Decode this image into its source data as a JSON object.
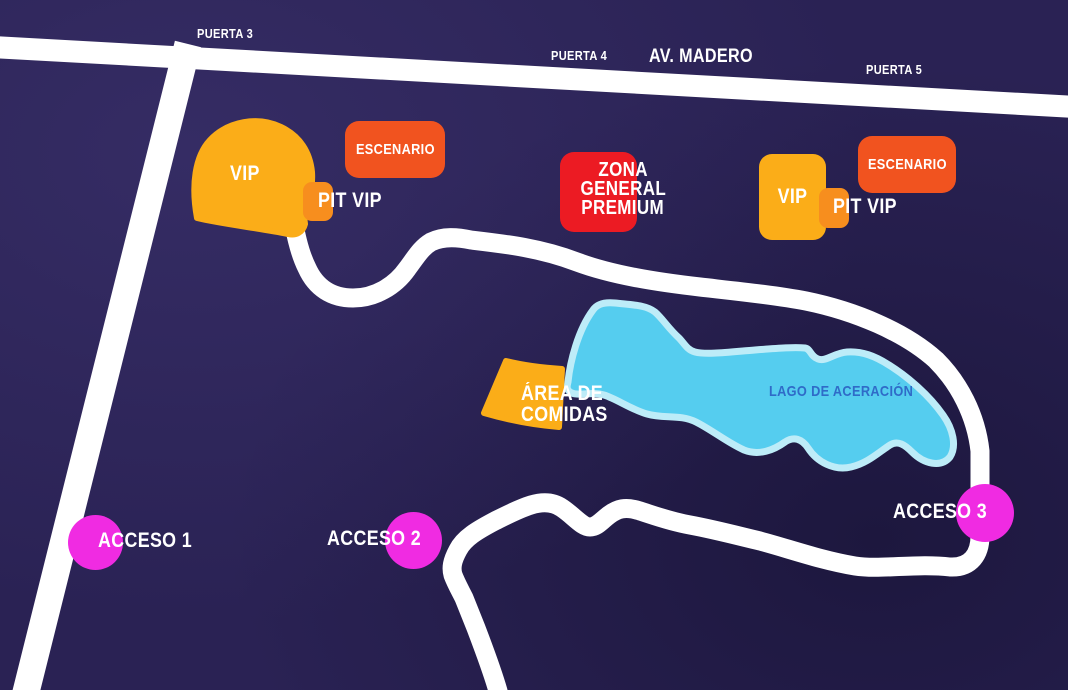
{
  "map": {
    "streets": {
      "puerta_3": "PUERTA 3",
      "puerta_4": "PUERTA 4",
      "av_madero": "AV. MADERO",
      "puerta_5": "PUERTA 5"
    },
    "zones": {
      "vip_left": "VIP",
      "escenario_left": "ESCENARIO",
      "pit_vip_left": "PIT VIP",
      "zona_general_premium": {
        "line_1": "ZONA",
        "line_2": "GENERAL",
        "line_3": "PREMIUM"
      },
      "vip_right": "VIP",
      "pit_vip_right": "PIT VIP",
      "escenario_right": "ESCENARIO",
      "area_comidas": {
        "line_1": "ÁREA DE",
        "line_2": "COMIDAS"
      }
    },
    "lake": {
      "label": "LAGO DE ACERACIÓN"
    },
    "accesses": {
      "acceso_1": "ACCESO 1",
      "acceso_2": "ACCESO 2",
      "acceso_3": "ACCESO 3"
    },
    "colors": {
      "background": "#2A2254",
      "road_white": "#FFFFFF",
      "vip_yellow": "#FBAD18",
      "stage_orange": "#F1531F",
      "pit_orange": "#F78E1E",
      "premium_red": "#EC1B23",
      "access_pink": "#F02BE2",
      "lake_fill": "#55CDEF",
      "lake_border": "#BDECF8",
      "lake_label_blue": "#2F6BC8"
    }
  }
}
